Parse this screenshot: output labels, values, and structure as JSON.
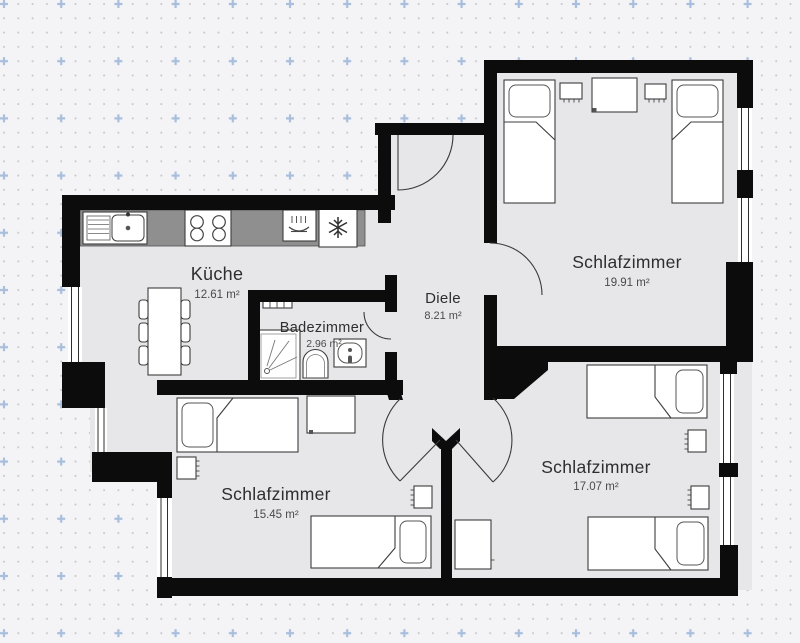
{
  "floor_plan": {
    "rooms": {
      "kueche": {
        "name": "Küche",
        "area": "12.61 m²"
      },
      "diele": {
        "name": "Diele",
        "area": "8.21 m²"
      },
      "badezimmer": {
        "name": "Badezimmer",
        "area": "2.96 m²"
      },
      "schlafzimmer_top_right": {
        "name": "Schlafzimmer",
        "area": "19.91 m²"
      },
      "schlafzimmer_bottom_left": {
        "name": "Schlafzimmer",
        "area": "15.45 m²"
      },
      "schlafzimmer_bottom_right": {
        "name": "Schlafzimmer",
        "area": "17.07 m²"
      }
    },
    "icons": {
      "freezer": "snowflake-icon",
      "dishwasher": "steam-dish-icon",
      "stove": "four-burner-icon",
      "sink": "basin-drainer-icon",
      "shower": "shower-spray-icon",
      "toilet": "toilet-icon",
      "washbasin": "washbasin-icon",
      "radiator": "radiator-icon"
    },
    "colors": {
      "wall": "#0c0c0c",
      "floor": "#e7e7e9",
      "background": "#f4f4f6",
      "grid_dot": "#c5c5cb",
      "grid_cross": "#a8bedc",
      "counter": "#8f8f8f"
    }
  }
}
